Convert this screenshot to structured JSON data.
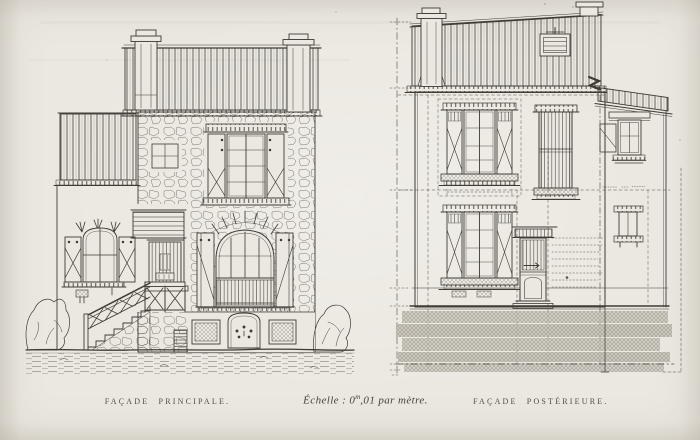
{
  "page": {
    "paper_color": "#ebe8e1",
    "ink_color": "#3e3b35",
    "halftone_color": "#c7c3b9"
  },
  "captions": {
    "left_facade": "FAÇADE PRINCIPALE.",
    "scale_prefix": "Échelle : 0",
    "scale_sup": "m",
    "scale_suffix": ",01 par mètre.",
    "right_facade": "FAÇADE POSTÉRIEURE."
  }
}
